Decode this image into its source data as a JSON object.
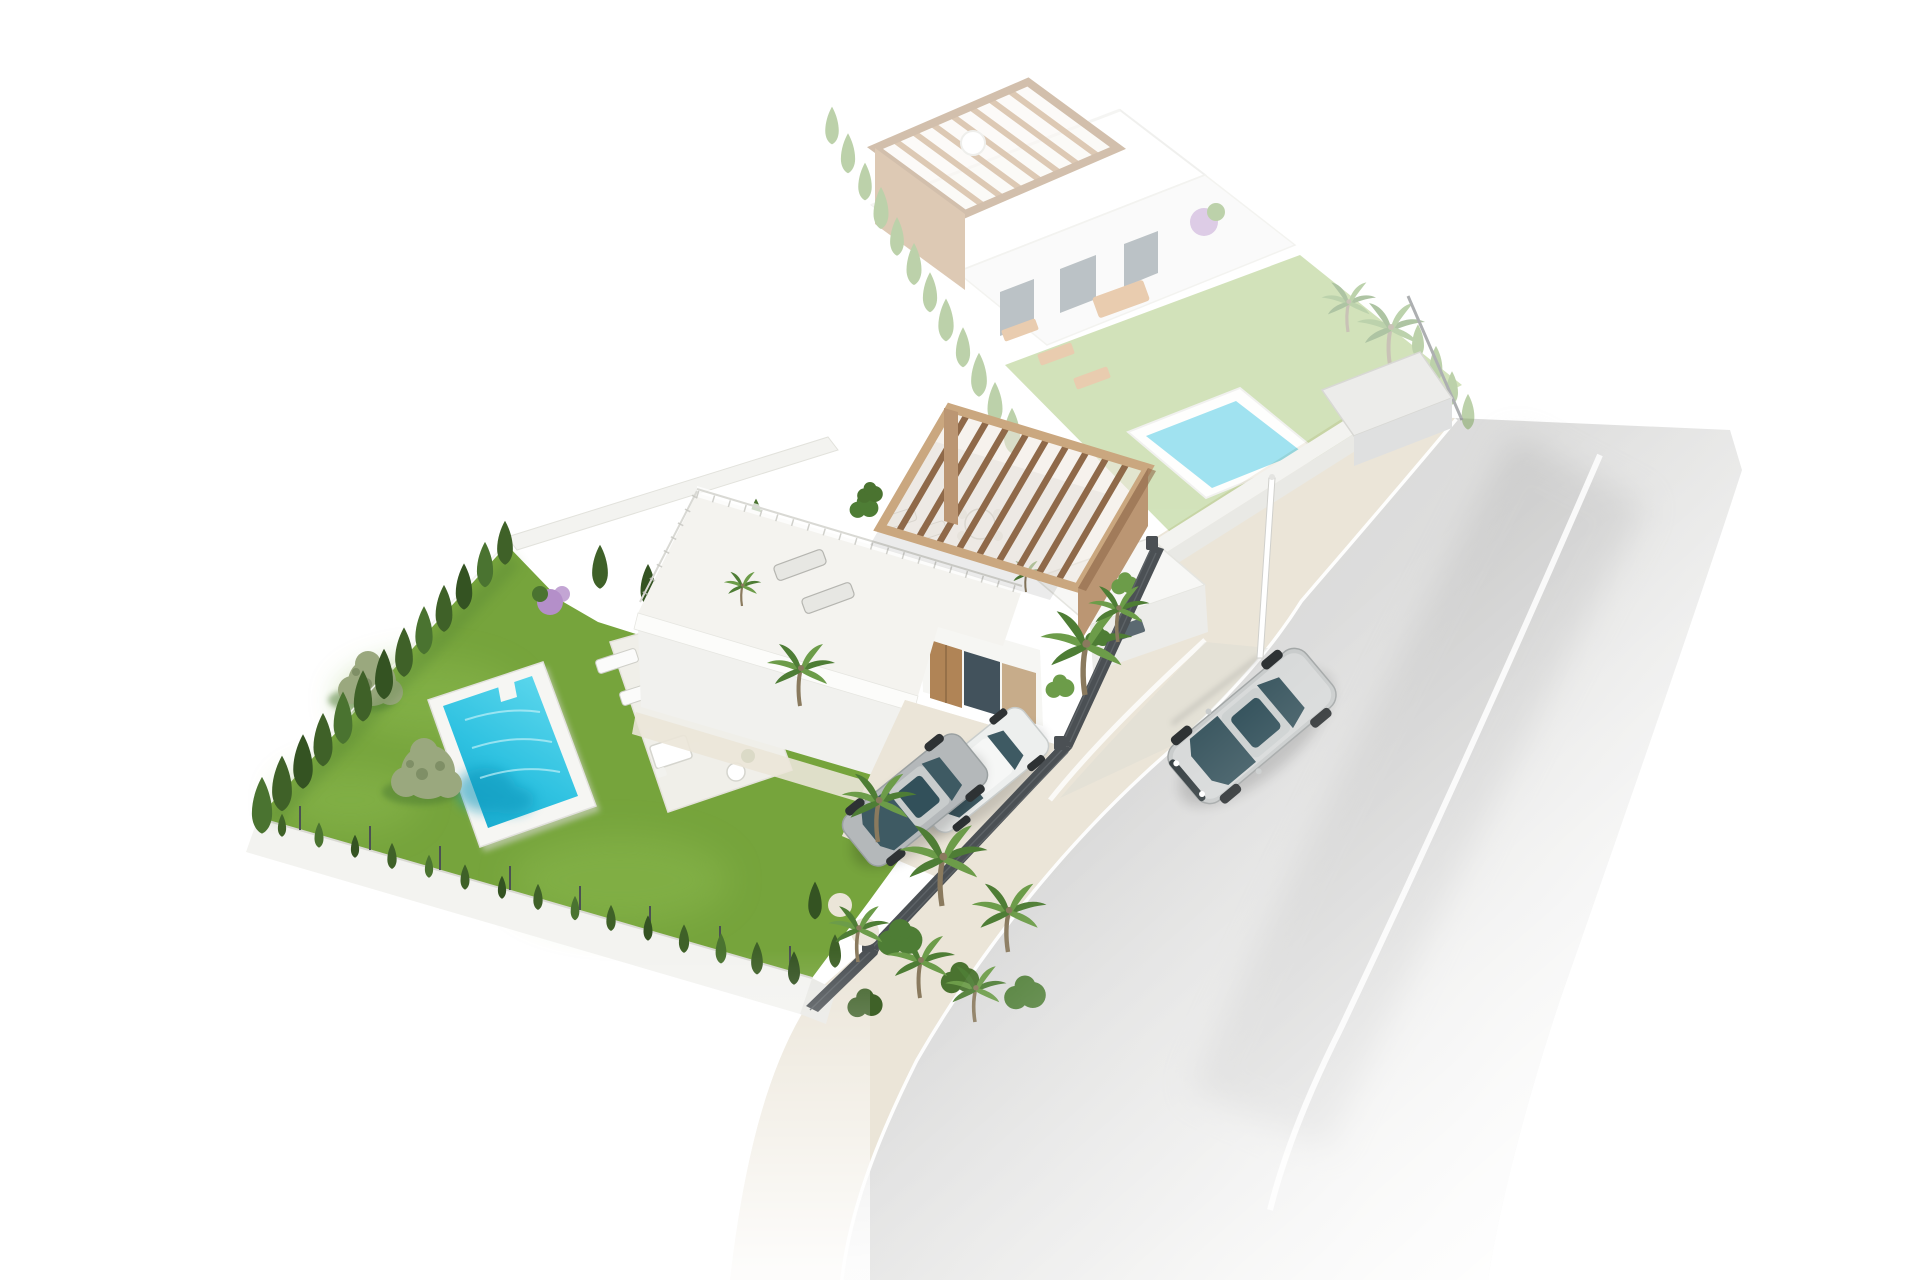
{
  "meta": {
    "title": "Aerial 3D architectural render of a villa plot",
    "description": "Isometric aerial 3D render: a modern white villa with wooden roof pergola, roof terrace with sun loungers, private pool, green lawn with cypress hedge and olive trees, two cars parked behind a dark slat fence, a ghosted neighboring villa with its own pergola and pool, a cobbled sidewalk, a street lamp and a silver sedan driving on a gray road.",
    "canvas": {
      "width": 1920,
      "height": 1280
    }
  },
  "palette": {
    "background": "#ffffff",
    "road": "#dadada",
    "road_dark": "#bdbdbd",
    "road_light": "#f3f3f2",
    "lane": "#ffffff",
    "sidewalk": "#ebe5d8",
    "sidewalk_dot": "#d6cdb7",
    "apron": "#dcdbd4",
    "grass": "#76a43c",
    "grass_light": "#8ab84e",
    "pool_deck": "#f6f6f3",
    "pool_water": "#3ec9e4",
    "pool_water_deep": "#17a9cd",
    "pool_water_dark": "#0f95ba",
    "cypress": "#3f6128",
    "cypress_dark": "#345322",
    "cypress_light": "#4a7330",
    "olive": "#9aa87e",
    "olive_dark": "#7f8f66",
    "palm": "#4e7d35",
    "palm_light": "#6c9c49",
    "trunk": "#8a7a5e",
    "wall": "#f3f3f0",
    "wall_edge": "#dddcd6",
    "wall_face": "#e9e9e5",
    "fence": "#4b5054",
    "fence_light": "#5f6569",
    "pergola_top": "#caa77f",
    "pergola_slat": "#8f6949",
    "pergola_wall": "#bb9673",
    "tan_panel": "#c7ac8a",
    "door_wood": "#b08456",
    "glass": "#42525c",
    "car_silver": "#b4b8ba",
    "car_white": "#edefee",
    "car_glass": "#3e5a63",
    "street_car_body": "#c9cccc",
    "street_car_hi": "#e4e6e6",
    "wheel": "#2e3234",
    "skin": "#c98f6e",
    "shirt": "#b5b164",
    "shorts": "#4a4a48",
    "purple": "#b48fc9",
    "faded_grass": "#9cc068",
    "faded_green": "#6d9b45",
    "faded_wood": "#b5885a",
    "faded_wood_dark": "#9c7348",
    "faded_water": "#2fc0de",
    "faded_furniture": "#cf8f4f",
    "faded_glass": "#6a7a82"
  },
  "objects": {
    "canvas": "3D aerial render of villa development",
    "road": "asphalt street",
    "lane_lines": "white road markings",
    "sidewalk": "cobbled sidewalk",
    "faded_villa": "ghosted neighboring villa plot",
    "faded_pool": "ghosted neighboring pool",
    "boundary_wall": "white boundary wall along street",
    "garage": "gray garage structure by the street",
    "lawn": "garden lawn",
    "pool": "private swimming pool",
    "patio": "pool patio with loungers and dining set",
    "person": "person standing on the patio",
    "olive_trees": "olive trees on the lawn",
    "purple_bush": "flowering purple shrub",
    "hedge_nw": "cypress hedge along north-west fence",
    "hedge_bottom": "shrub row along bottom wall",
    "house": "modern white villa",
    "roof_terrace": "roof terrace with sun loungers and dining table",
    "pergola": "wooden roof pergola",
    "facade": "villa front facade with wooden door and glazing",
    "driveway": "cobbled driveway parking",
    "car_silver": "parked silver car",
    "car_white": "parked white car",
    "fence": "dark slat boundary fence",
    "palms": "palm tree cluster in the garden corner",
    "street_lamp": "street lamp post",
    "street_car": "silver sedan driving on the street"
  }
}
